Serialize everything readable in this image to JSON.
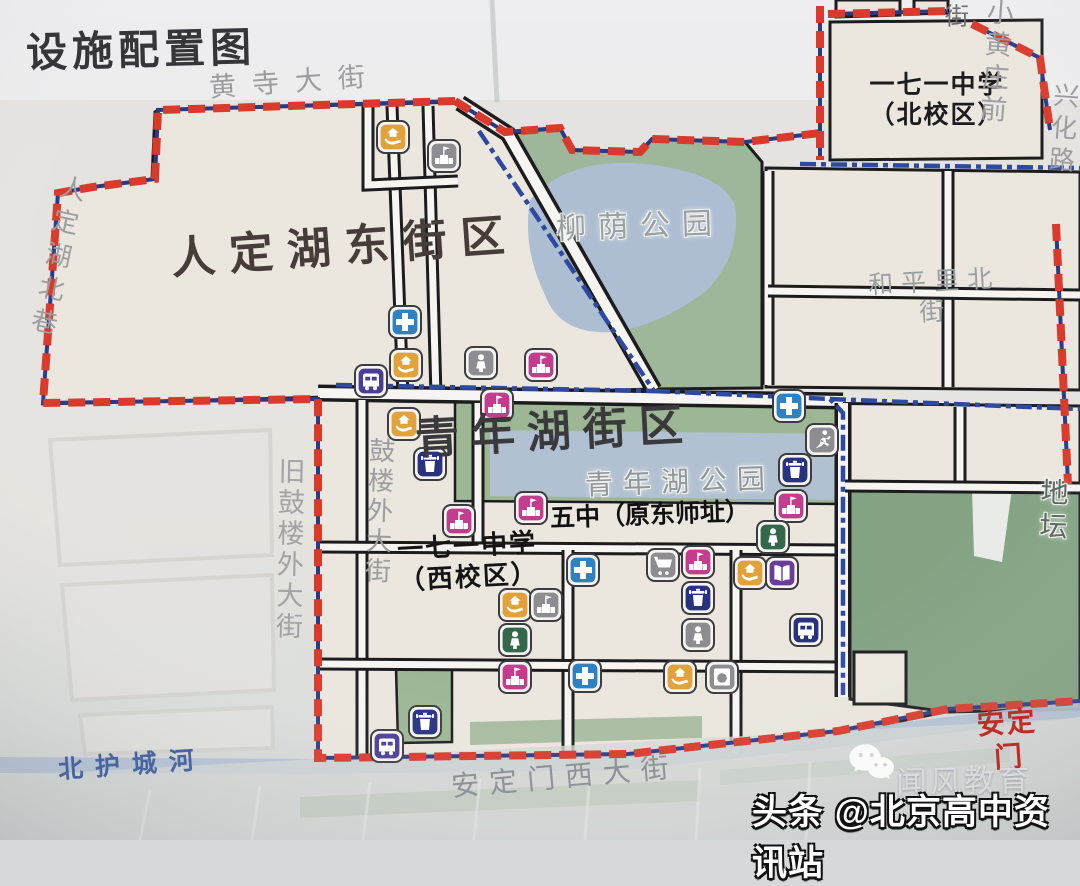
{
  "title": "设施配置图",
  "watermark": {
    "brand": "闻风教育",
    "toutiao": "头条 @北京高中资讯站",
    "wechat_icon": "wechat-icon"
  },
  "map": {
    "boundary_colors": {
      "district_boundary_red": "#d93a2b",
      "sub_boundary_blue": "#2e4aa0",
      "boundary_underlay_navy": "#2b3a85"
    },
    "icon_colors": {
      "blue": "#2e82c2",
      "orange": "#e2a23b",
      "pink": "#c33d8e",
      "gray": "#8d8d91",
      "purple": "#4a3d98",
      "navy": "#27337f",
      "green": "#33684a",
      "violet": "#6a3d98"
    },
    "district_labels": [
      {
        "name": "rendinghu-east-district-label",
        "t": "人定湖东街区",
        "x": 345,
        "y": 248,
        "fs": 44,
        "c": "#463c3a",
        "b": 1,
        "ls": 14,
        "rot": -4
      },
      {
        "name": "qingnianhu-district-label",
        "t": "青年湖街区",
        "x": 555,
        "y": 433,
        "fs": 44,
        "c": "#3a3a3c",
        "b": 1,
        "ls": 12,
        "rot": -3
      }
    ],
    "school_labels": [
      {
        "name": "school-171-north-campus-label",
        "t": "一七一中学\n（北校区）",
        "x": 937,
        "y": 100,
        "fs": 25,
        "c": "#1c1c1e",
        "b": 1,
        "ls": 2,
        "rot": 0
      },
      {
        "name": "school-171-west-campus-label",
        "t": "一七一中学\n（西校区）",
        "x": 468,
        "y": 562,
        "fs": 26,
        "c": "#141414",
        "b": 1,
        "ls": 2,
        "rot": -3
      },
      {
        "name": "school-no5-label",
        "t": "五中（原东师址）",
        "x": 650,
        "y": 515,
        "fs": 25,
        "c": "#111111",
        "b": 1,
        "ls": 0,
        "rot": -2
      }
    ],
    "park_labels": [
      {
        "name": "liuyin-park-label",
        "t": "柳荫公园",
        "x": 640,
        "y": 227,
        "fs": 30,
        "c": "#98a0a4",
        "ls": 12,
        "rot": -2,
        "halo": 1
      },
      {
        "name": "qingnianhu-park-label",
        "t": "青年湖公园",
        "x": 680,
        "y": 482,
        "fs": 28,
        "c": "#8f979b",
        "ls": 10,
        "rot": -2,
        "halo": 1
      },
      {
        "name": "ditan-park-label",
        "t": "地 坛",
        "x": 1057,
        "y": 510,
        "fs": 28,
        "c": "#5f6a66",
        "ls": 6,
        "rot": 2,
        "halo": 1
      }
    ],
    "street_labels": [
      {
        "name": "huangsi-street-label",
        "t": "黄寺大街",
        "x": 295,
        "y": 82,
        "fs": 27,
        "c": "#9d9d9f",
        "ls": 16,
        "rot": -4
      },
      {
        "name": "rendinghu-north-alley-label",
        "t": "人定湖北巷",
        "x": 56,
        "y": 258,
        "fs": 26,
        "c": "#9d9da0",
        "ls": 8,
        "rot": 12,
        "vert": 1
      },
      {
        "name": "xiaohuangzhuang-front-street-label",
        "t": "小黄庄前",
        "x": 1003,
        "y": 62,
        "fs": 27,
        "c": "#9d9da0",
        "ls": 12,
        "rot": 4
      },
      {
        "name": "xiaohuangzhuang-street-suffix-label",
        "t": "街",
        "x": 957,
        "y": 18,
        "fs": 24,
        "c": "#6f6f72",
        "ls": 0,
        "rot": 0
      },
      {
        "name": "xinghua-road-label",
        "t": "兴化路",
        "x": 1062,
        "y": 130,
        "fs": 26,
        "c": "#9d9da0",
        "ls": 6,
        "rot": 4,
        "vert": 1
      },
      {
        "name": "hepingli-north-street-label",
        "t": "和平里北街",
        "x": 935,
        "y": 297,
        "fs": 25,
        "c": "#9aa0a2",
        "ls": 8,
        "rot": -3
      },
      {
        "name": "gulou-outer-street-label",
        "t": "鼓楼外大街",
        "x": 378,
        "y": 512,
        "fs": 26,
        "c": "#9d9da0",
        "ls": 4,
        "rot": 2,
        "vert": 1
      },
      {
        "name": "old-gulou-outer-street-label",
        "t": "旧鼓楼外大街",
        "x": 288,
        "y": 550,
        "fs": 27,
        "c": "#a3a3a5",
        "ls": 4,
        "rot": 1,
        "vert": 1
      },
      {
        "name": "north-moat-river-label",
        "t": "北护城河",
        "x": 132,
        "y": 765,
        "fs": 25,
        "c": "#47659e",
        "b": 1,
        "ls": 12,
        "rot": -4
      },
      {
        "name": "andingmen-west-street-label",
        "t": "安定门西大街",
        "x": 565,
        "y": 777,
        "fs": 28,
        "c": "#8e9397",
        "ls": 10,
        "rot": -5
      },
      {
        "name": "andingmen-label",
        "t": "安定门",
        "x": 1008,
        "y": 740,
        "fs": 28,
        "c": "#bf2d26",
        "b": 1,
        "ls": 2,
        "rot": -4
      }
    ],
    "poi_icons": [
      {
        "x": 393,
        "y": 137,
        "color": "orange",
        "glyph": "hand"
      },
      {
        "x": 444,
        "y": 156,
        "color": "gray",
        "glyph": "school"
      },
      {
        "x": 405,
        "y": 322,
        "color": "blue",
        "glyph": "cross"
      },
      {
        "x": 406,
        "y": 365,
        "color": "orange",
        "glyph": "hand"
      },
      {
        "x": 481,
        "y": 363,
        "color": "gray",
        "glyph": "person"
      },
      {
        "x": 541,
        "y": 365,
        "color": "pink",
        "glyph": "school"
      },
      {
        "x": 371,
        "y": 381,
        "color": "purple",
        "glyph": "bus"
      },
      {
        "x": 497,
        "y": 405,
        "color": "pink",
        "glyph": "school"
      },
      {
        "x": 404,
        "y": 424,
        "color": "orange",
        "glyph": "hand"
      },
      {
        "x": 430,
        "y": 464,
        "color": "navy",
        "glyph": "trash"
      },
      {
        "x": 459,
        "y": 521,
        "color": "pink",
        "glyph": "school"
      },
      {
        "x": 531,
        "y": 508,
        "color": "pink",
        "glyph": "school"
      },
      {
        "x": 789,
        "y": 406,
        "color": "blue",
        "glyph": "cross"
      },
      {
        "x": 822,
        "y": 440,
        "color": "gray",
        "glyph": "runner"
      },
      {
        "x": 795,
        "y": 470,
        "color": "navy",
        "glyph": "trash"
      },
      {
        "x": 791,
        "y": 506,
        "color": "pink",
        "glyph": "school"
      },
      {
        "x": 583,
        "y": 570,
        "color": "blue",
        "glyph": "cross"
      },
      {
        "x": 663,
        "y": 565,
        "color": "gray",
        "glyph": "cart"
      },
      {
        "x": 698,
        "y": 562,
        "color": "pink",
        "glyph": "school"
      },
      {
        "x": 773,
        "y": 537,
        "color": "green",
        "glyph": "person"
      },
      {
        "x": 750,
        "y": 573,
        "color": "orange",
        "glyph": "hand"
      },
      {
        "x": 782,
        "y": 573,
        "color": "violet",
        "glyph": "book"
      },
      {
        "x": 698,
        "y": 598,
        "color": "navy",
        "glyph": "trash"
      },
      {
        "x": 698,
        "y": 635,
        "color": "gray",
        "glyph": "person"
      },
      {
        "x": 806,
        "y": 630,
        "color": "navy",
        "glyph": "bus"
      },
      {
        "x": 515,
        "y": 605,
        "color": "orange",
        "glyph": "hand"
      },
      {
        "x": 546,
        "y": 605,
        "color": "gray",
        "glyph": "school"
      },
      {
        "x": 515,
        "y": 640,
        "color": "green",
        "glyph": "person"
      },
      {
        "x": 515,
        "y": 677,
        "color": "pink",
        "glyph": "school"
      },
      {
        "x": 585,
        "y": 676,
        "color": "blue",
        "glyph": "cross"
      },
      {
        "x": 680,
        "y": 677,
        "color": "orange",
        "glyph": "hand"
      },
      {
        "x": 722,
        "y": 677,
        "color": "gray",
        "glyph": "washer"
      },
      {
        "x": 425,
        "y": 722,
        "color": "navy",
        "glyph": "trash"
      },
      {
        "x": 387,
        "y": 746,
        "color": "purple",
        "glyph": "bus"
      }
    ]
  }
}
